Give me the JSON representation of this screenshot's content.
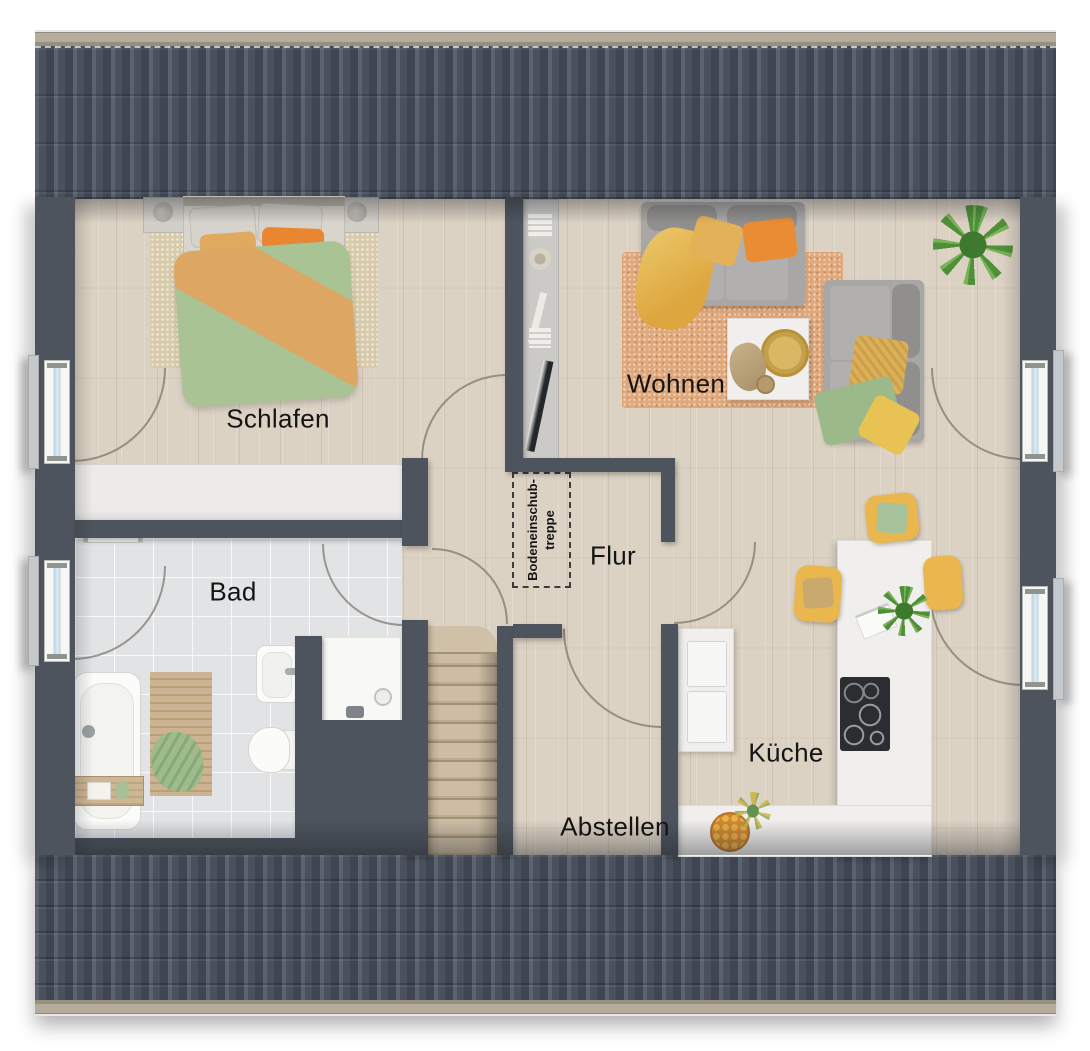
{
  "plan": {
    "type": "floor-plan-top-view",
    "rooms": {
      "schlafen": {
        "label": "Schlafen"
      },
      "wohnen": {
        "label": "Wohnen"
      },
      "bad": {
        "label": "Bad"
      },
      "flur": {
        "label": "Flur"
      },
      "kueche": {
        "label": "Küche"
      },
      "abstellen": {
        "label": "Abstellen"
      }
    },
    "attic_hatch": {
      "line1": "Bodeneinschub-",
      "line2": "treppe"
    }
  },
  "colors": {
    "wall": "#4d545d",
    "roof": "#49505b",
    "roof_trim": "#b5ac9d",
    "floor_wood": "#dcd2c4",
    "floor_tile": "#e1e3e5",
    "rug_living": "#e0a87b",
    "rug_bedroom": "#d7cbaa",
    "sofa_gray": "#a8a7a5",
    "duvet_green": "#a9c394",
    "duvet_orange": "#dda763",
    "pillow_orange": "#ea8c33",
    "stool_yellow": "#e9b74d",
    "counter_white": "#f0efed",
    "cooktop_black": "#2b2d31",
    "stairs_wood": "#c9b89f",
    "window_glass": "#c9dfe9",
    "label_text": "#141414"
  }
}
